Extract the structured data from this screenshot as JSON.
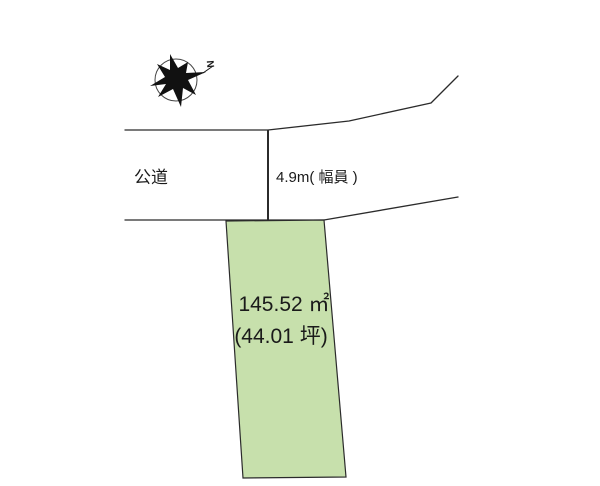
{
  "diagram": {
    "title": "land-plot-site-diagram",
    "background_color": "#ffffff",
    "line_color": "#2b2b2b",
    "road": {
      "label": "公道",
      "width_label": "4.9m( 幅員 )"
    },
    "plot": {
      "area_sqm": "145.52 ㎡",
      "area_tsubo": "(44.01 坪)",
      "fill_color": "#c7e0ac",
      "border_color": "#2b2b2b"
    },
    "compass": {
      "north_label": "N",
      "star_color": "#111111"
    }
  }
}
